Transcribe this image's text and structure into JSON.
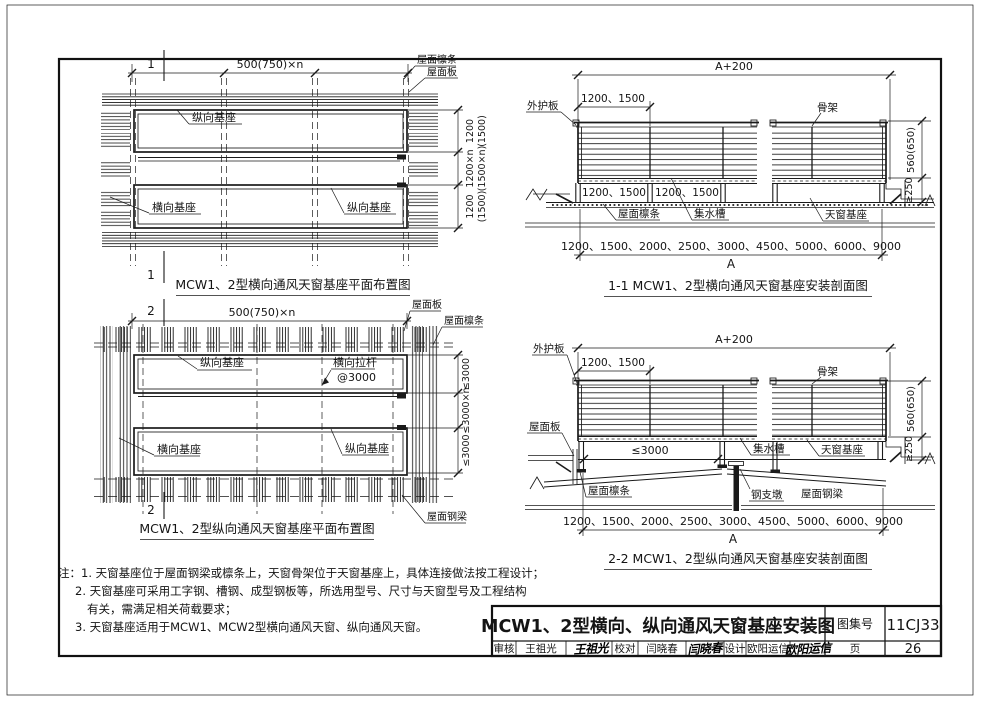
{
  "titleblock": {
    "title": "MCW1、2型横向、纵向通风天窗基座安装图",
    "atlas_no_label": "图集号",
    "atlas_no": "11CJ33",
    "page_label": "页",
    "page_no": "26",
    "review_label": "审核",
    "reviewer": "王祖光",
    "reviewer_signature": "王祖光",
    "check_label": "校对",
    "checker": "闫晓春",
    "checker_signature": "闫晓春",
    "design_label": "设计",
    "designer": "欧阳运信",
    "designer_signature": "欧阳运信"
  },
  "notes": {
    "line1": "注：1. 天窗基座位于屋面钢梁或檩条上，天窗骨架位于天窗基座上，具体连接做法按工程设计；",
    "line2": "2. 天窗基座可采用工字钢、槽钢、成型钢板等，所选用型号、尺寸与天窗型号及工程结构",
    "line3": "有关，需满足相关荷载要求；",
    "line4": "3. 天窗基座适用于MCW1、MCW2型横向通风天窗、纵向通风天窗。"
  },
  "plan1": {
    "section_mark": "1",
    "dim_top": "500(750)×n",
    "label_purlin": "屋面檩条",
    "label_panel": "屋面板",
    "label_long_base_top": "纵向基座",
    "label_trans_base": "横向基座",
    "label_long_base_bottom": "纵向基座",
    "dim_right_1": "1200",
    "dim_right_1_alt": "(1500)",
    "dim_right_2": "1200×n",
    "dim_right_2_alt": "(1500×n)",
    "dim_right_3": "1200",
    "dim_right_3_alt": "(1500)",
    "caption": "MCW1、2型横向通风天窗基座平面布置图"
  },
  "section1": {
    "dim_overall": "A+200",
    "dim_spacing": "1200、1500",
    "label_cladding": "外护板",
    "label_frame": "骨架",
    "dim_base_1": "1200、1500",
    "dim_base_2": "1200、1500",
    "label_purlin": "屋面檩条",
    "label_gutter": "集水槽",
    "label_base": "天窗基座",
    "dim_height": "560(650)",
    "dim_min_height": "≥250",
    "dim_widths": "1200、1500、2000、2500、3000、4500、5000、6000、9000",
    "dim_a": "A",
    "caption": "1-1  MCW1、2型横向通风天窗基座安装剖面图"
  },
  "plan2": {
    "section_mark": "2",
    "dim_top": "500(750)×n",
    "label_panel": "屋面板",
    "label_purlin": "屋面檩条",
    "label_long_base_top": "纵向基座",
    "label_tie_rod": "横向拉杆",
    "label_tie_rod_spacing": "@3000",
    "label_trans_base": "横向基座",
    "label_long_base_bottom": "纵向基座",
    "label_roof_beam": "屋面钢梁",
    "dim_right_1": "≤3000",
    "dim_right_2": "≤3000×n",
    "dim_right_3": "≤3000",
    "caption": "MCW1、2型纵向通风天窗基座平面布置图"
  },
  "section2": {
    "dim_overall": "A+200",
    "dim_spacing": "1200、1500",
    "label_cladding": "外护板",
    "label_frame": "骨架",
    "label_panel": "屋面板",
    "dim_spacing_max": "≤3000",
    "label_gutter": "集水槽",
    "label_base": "天窗基座",
    "label_purlin": "屋面檩条",
    "label_pier": "钢支墩",
    "label_roof_beam": "屋面钢梁",
    "dim_height": "560(650)",
    "dim_min_height": "≥250",
    "dim_widths": "1200、1500、2000、2500、3000、4500、5000、6000、9000",
    "dim_a": "A",
    "caption": "2-2  MCW1、2型纵向通风天窗基座安装剖面图"
  }
}
